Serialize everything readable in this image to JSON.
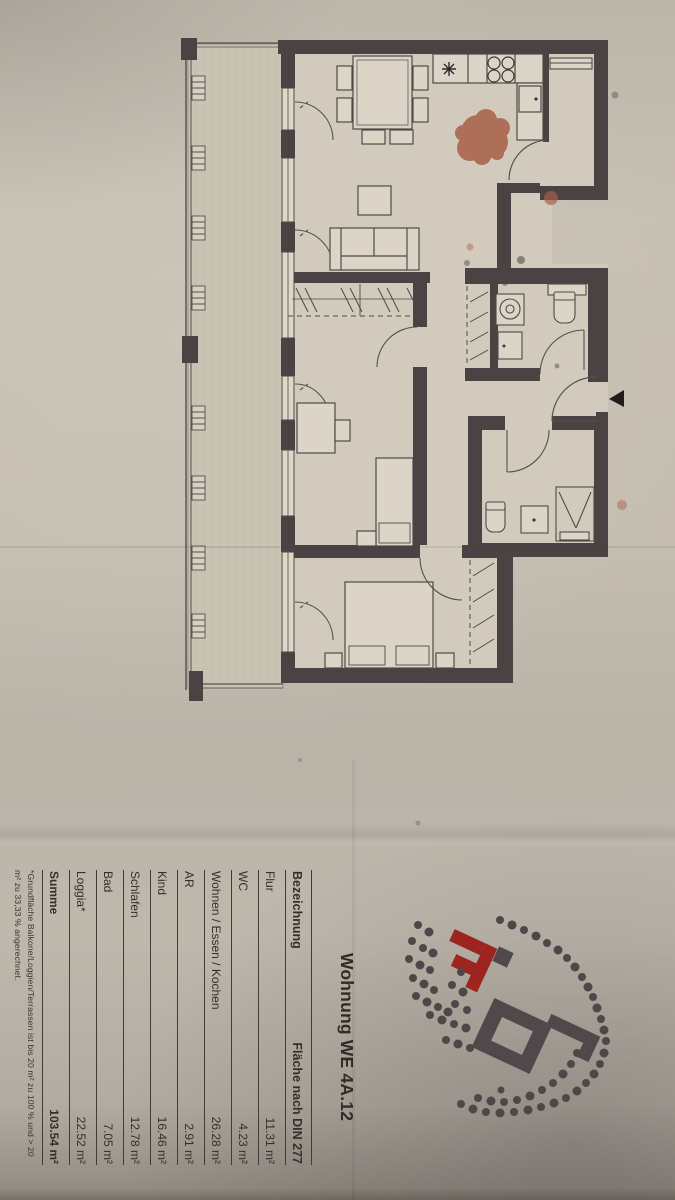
{
  "document": {
    "title": "Wohnung WE 4A.12",
    "table": {
      "header": {
        "name": "Bezeichnung",
        "area": "Fläche nach DIN 277"
      },
      "rows": [
        {
          "label": "Flur",
          "value": "11.31 m²"
        },
        {
          "label": "WC",
          "value": "4.23 m²"
        },
        {
          "label": "Wohnen / Essen / Kochen",
          "value": "26.28 m²"
        },
        {
          "label": "AR",
          "value": "2.91 m²"
        },
        {
          "label": "Kind",
          "value": "16.46 m²"
        },
        {
          "label": "Schlafen",
          "value": "12.78 m²"
        },
        {
          "label": "Bad",
          "value": "7.05 m²"
        },
        {
          "label": "Loggia*",
          "value": "22.52 m²"
        }
      ],
      "total": {
        "label": "Summe",
        "value": "103.54 m²"
      }
    },
    "footnote": "*Grundfläche Balkone/Loggien/Terrassen ist bis 20 m² zu 100 % und > 20 m² zu 33,33 % angerechnet."
  },
  "colors": {
    "paper": "#c4bdb0",
    "wall": "#4b4243",
    "room_fill": "#d2cbbd",
    "loggia_fill": "#c9c3b3",
    "stain": "#a75f46",
    "logo_red": "#9e2420",
    "logo_gray": "#51484b",
    "text": "#33302b"
  }
}
